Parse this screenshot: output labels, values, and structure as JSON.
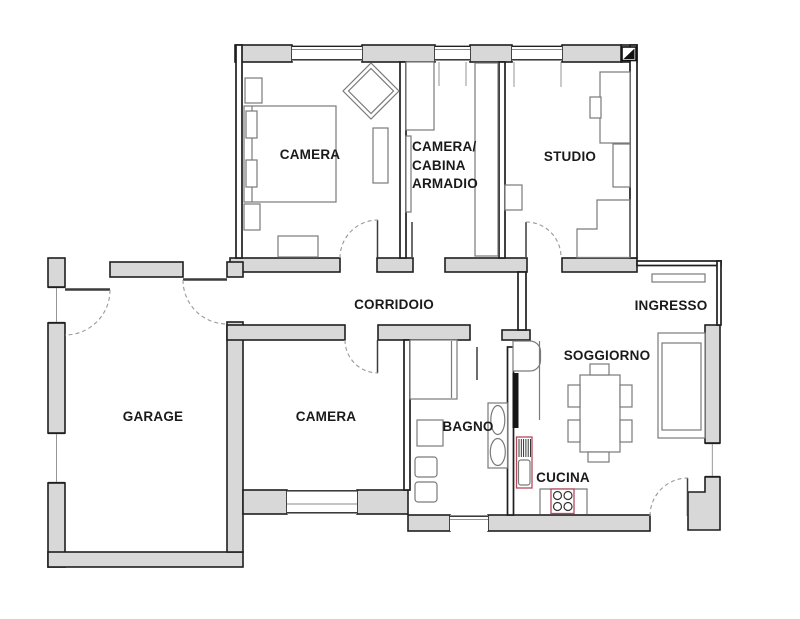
{
  "title": "Apartment floor plan",
  "colors": {
    "background": "#ffffff",
    "wall_fill": "#d8d8d8",
    "wall_stroke": "#1f1f1f",
    "furniture_stroke": "#7a7a7a",
    "door_stroke": "#999999",
    "appliance_accent": "#b34a5e",
    "label_color": "#1a1a1a"
  },
  "rooms": [
    {
      "id": "camera-top",
      "label": "CAMERA"
    },
    {
      "id": "camera-cabina-armadio",
      "label": "CAMERA/ CABINA ARMADIO",
      "lines": [
        "CAMERA/",
        "CABINA",
        "ARMADIO"
      ]
    },
    {
      "id": "studio",
      "label": "STUDIO"
    },
    {
      "id": "corridoio",
      "label": "CORRIDOIO"
    },
    {
      "id": "ingresso",
      "label": "INGRESSO"
    },
    {
      "id": "garage",
      "label": "GARAGE"
    },
    {
      "id": "camera-bottom",
      "label": "CAMERA"
    },
    {
      "id": "bagno",
      "label": "BAGNO"
    },
    {
      "id": "soggiorno",
      "label": "SOGGIORNO"
    },
    {
      "id": "cucina",
      "label": "CUCINA"
    }
  ]
}
